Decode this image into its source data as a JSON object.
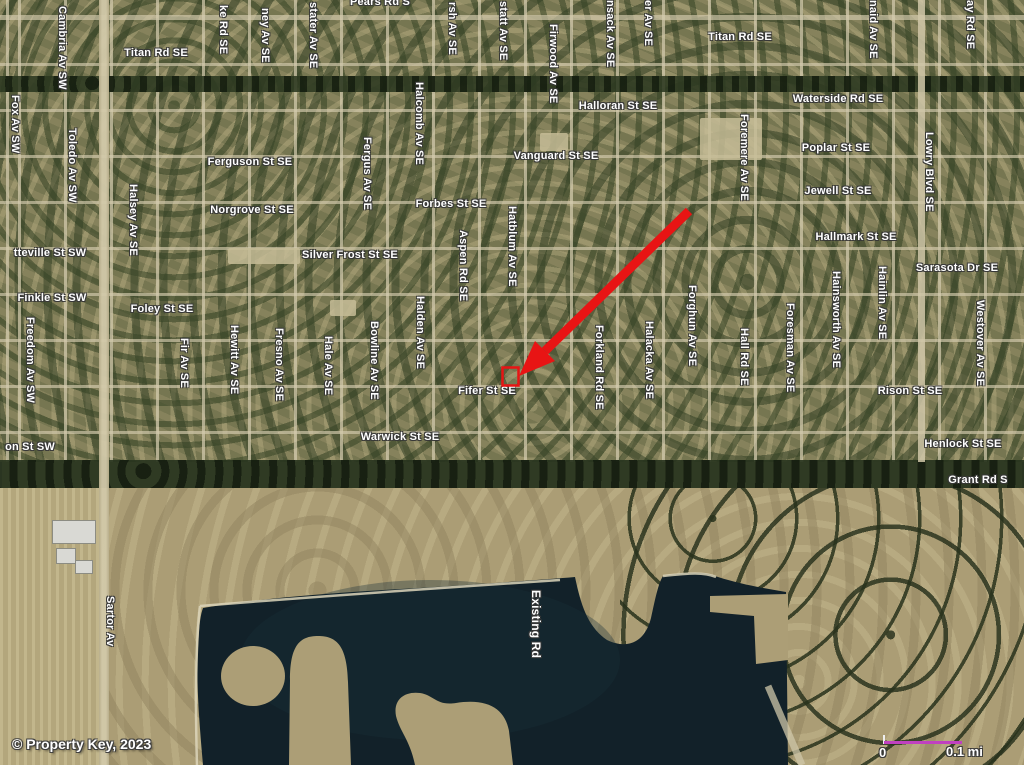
{
  "title": "Aerial property location map",
  "attribution": "© Property Key, 2023",
  "scale_bar": {
    "start_label": "0",
    "end_label": "0.1 mi",
    "bar_color": "#c040c0"
  },
  "annotation": {
    "arrow_color": "#e81414",
    "marker_shape": "red-outline-rectangle",
    "marker_x": 502,
    "marker_y": 367
  },
  "colors": {
    "suburb_base": "#83805a",
    "rural_base": "#ab9d75",
    "lake": "#122129",
    "road": "#d2c9a9",
    "trees": "#2e3a24"
  },
  "street_labels": [
    {
      "text": "Pears Rd S",
      "x": 380,
      "y": -4,
      "dir": "h"
    },
    {
      "text": "Titan Rd SE",
      "x": 156,
      "y": 47,
      "dir": "h"
    },
    {
      "text": "Titan Rd SE",
      "x": 740,
      "y": 31,
      "dir": "h"
    },
    {
      "text": "Waterside Rd SE",
      "x": 838,
      "y": 93,
      "dir": "h"
    },
    {
      "text": "Halloran St SE",
      "x": 618,
      "y": 100,
      "dir": "h"
    },
    {
      "text": "Poplar St SE",
      "x": 836,
      "y": 142,
      "dir": "h"
    },
    {
      "text": "Vanguard St SE",
      "x": 556,
      "y": 150,
      "dir": "h"
    },
    {
      "text": "Ferguson St SE",
      "x": 250,
      "y": 156,
      "dir": "h"
    },
    {
      "text": "Jewell St SE",
      "x": 838,
      "y": 185,
      "dir": "h"
    },
    {
      "text": "Norgrove St SE",
      "x": 252,
      "y": 204,
      "dir": "h"
    },
    {
      "text": "Forbes St SE",
      "x": 451,
      "y": 198,
      "dir": "h"
    },
    {
      "text": "Hallmark St SE",
      "x": 856,
      "y": 231,
      "dir": "h"
    },
    {
      "text": "tteville St SW",
      "x": 50,
      "y": 247,
      "dir": "h"
    },
    {
      "text": "Silver Frost St SE",
      "x": 350,
      "y": 249,
      "dir": "h"
    },
    {
      "text": "Sarasota Dr SE",
      "x": 957,
      "y": 262,
      "dir": "h"
    },
    {
      "text": "Finkle St SW",
      "x": 52,
      "y": 292,
      "dir": "h"
    },
    {
      "text": "Foley St SE",
      "x": 162,
      "y": 303,
      "dir": "h"
    },
    {
      "text": "Fifer St SE",
      "x": 487,
      "y": 385,
      "dir": "h"
    },
    {
      "text": "Rison St SE",
      "x": 910,
      "y": 385,
      "dir": "h"
    },
    {
      "text": "Warwick St SE",
      "x": 400,
      "y": 431,
      "dir": "h"
    },
    {
      "text": "on St SW",
      "x": 30,
      "y": 441,
      "dir": "h"
    },
    {
      "text": "Henlock St SE",
      "x": 963,
      "y": 438,
      "dir": "h"
    },
    {
      "text": "Grant Rd S",
      "x": 978,
      "y": 474,
      "dir": "h"
    },
    {
      "text": "Cambria Av SW",
      "x": 62,
      "y": 6,
      "dir": "v"
    },
    {
      "text": "ke Rd SE",
      "x": 223,
      "y": 5,
      "dir": "v"
    },
    {
      "text": "ney Av SE",
      "x": 265,
      "y": 8,
      "dir": "v"
    },
    {
      "text": "stater Av SE",
      "x": 313,
      "y": 2,
      "dir": "v"
    },
    {
      "text": "rsh Av SE",
      "x": 452,
      "y": 2,
      "dir": "v"
    },
    {
      "text": "statt Av SE",
      "x": 503,
      "y": 1,
      "dir": "v"
    },
    {
      "text": "nsack Av SE",
      "x": 610,
      "y": 0,
      "dir": "v"
    },
    {
      "text": "er Av SE",
      "x": 648,
      "y": 0,
      "dir": "v"
    },
    {
      "text": "naid Av SE",
      "x": 873,
      "y": 0,
      "dir": "v"
    },
    {
      "text": "ay Rd SE",
      "x": 970,
      "y": 0,
      "dir": "v"
    },
    {
      "text": "Firwood Av SE",
      "x": 553,
      "y": 24,
      "dir": "v"
    },
    {
      "text": "Fox Av SW",
      "x": 15,
      "y": 95,
      "dir": "v"
    },
    {
      "text": "Halcomb Av SE",
      "x": 419,
      "y": 82,
      "dir": "v"
    },
    {
      "text": "Foremere Av SE",
      "x": 744,
      "y": 114,
      "dir": "v"
    },
    {
      "text": "Toledo Av SW",
      "x": 72,
      "y": 128,
      "dir": "v"
    },
    {
      "text": "Lowry Blvd SE",
      "x": 929,
      "y": 132,
      "dir": "v"
    },
    {
      "text": "Fergus Av SE",
      "x": 367,
      "y": 137,
      "dir": "v"
    },
    {
      "text": "Halsey Av SE",
      "x": 133,
      "y": 184,
      "dir": "v"
    },
    {
      "text": "Hatblum Av SE",
      "x": 512,
      "y": 206,
      "dir": "v"
    },
    {
      "text": "Aspen Rd SE",
      "x": 463,
      "y": 230,
      "dir": "v"
    },
    {
      "text": "Hainlin Av SE",
      "x": 882,
      "y": 266,
      "dir": "v"
    },
    {
      "text": "Hainsworth Av SE",
      "x": 836,
      "y": 271,
      "dir": "v"
    },
    {
      "text": "Forghun Av SE",
      "x": 692,
      "y": 285,
      "dir": "v"
    },
    {
      "text": "Halden Av SE",
      "x": 420,
      "y": 296,
      "dir": "v"
    },
    {
      "text": "Westover Av SE",
      "x": 980,
      "y": 300,
      "dir": "v"
    },
    {
      "text": "Foresman Av SE",
      "x": 790,
      "y": 303,
      "dir": "v"
    },
    {
      "text": "Freedom Av SW",
      "x": 30,
      "y": 317,
      "dir": "v"
    },
    {
      "text": "Bowline Av SE",
      "x": 374,
      "y": 321,
      "dir": "v"
    },
    {
      "text": "Halacka Av SE",
      "x": 649,
      "y": 321,
      "dir": "v"
    },
    {
      "text": "Forkland Rd SE",
      "x": 599,
      "y": 325,
      "dir": "v"
    },
    {
      "text": "Hewitt Av SE",
      "x": 234,
      "y": 325,
      "dir": "v"
    },
    {
      "text": "Fresno Av SE",
      "x": 279,
      "y": 328,
      "dir": "v"
    },
    {
      "text": "Hall Rd SE",
      "x": 744,
      "y": 328,
      "dir": "v"
    },
    {
      "text": "Hale Av SE",
      "x": 328,
      "y": 336,
      "dir": "v"
    },
    {
      "text": "Fir Av SE",
      "x": 184,
      "y": 338,
      "dir": "v"
    },
    {
      "text": "Sartor Av",
      "x": 110,
      "y": 596,
      "dir": "v"
    },
    {
      "text": "Existing Rd",
      "x": 536,
      "y": 590,
      "dir": "v",
      "big": true
    }
  ]
}
